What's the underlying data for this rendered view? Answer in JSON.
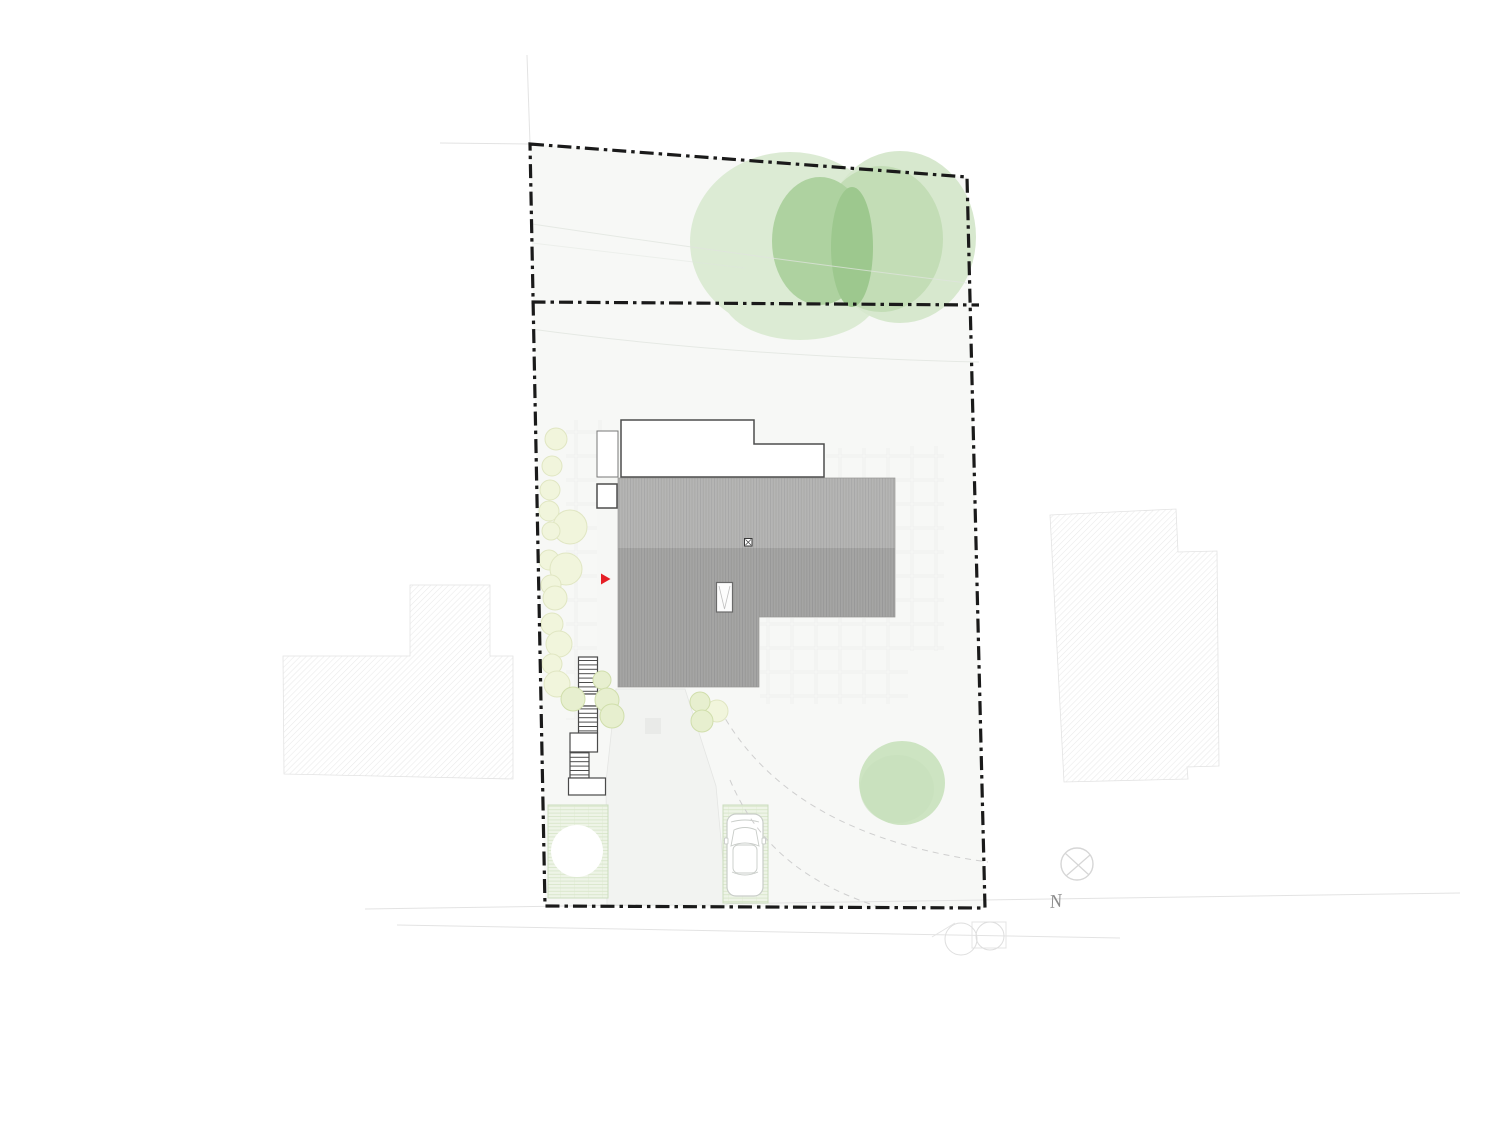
{
  "compass": {
    "north_label": "N"
  },
  "colors": {
    "boundary": "#1a1a1a",
    "interior": "#f7f8f6",
    "roof-light": "#b5b5b4",
    "roof-line-light": "#a7a7a6",
    "roof-dark": "#a5a5a4",
    "roof-line-dark": "#979796",
    "building-outline": "#4d4d4d",
    "hatch": "#e9e9e9",
    "driveway": "#f2f3f1",
    "driveway-edge": "#e4e5e3",
    "ghost": "#efefef",
    "faint": "#e3e3e3",
    "contour": "#e0e4de",
    "tree-pale": "#dcebd4",
    "tree-mid": "#c3ddb6",
    "tree-dark": "#aed2a0",
    "tree-overlap": "#9dc88e",
    "tree-single": "#cde4c2",
    "grass-bg": "#eef4e7",
    "grass-line": "#d9e7cb",
    "grass-border": "#cbdcbd",
    "shrub-pale": "#f1f5dc",
    "shrub-pale-edge": "#e0e6c2",
    "shrub-green": "#e7efcf",
    "shrub-green-edge": "#d0deab",
    "accent-red": "#e51f26",
    "compass-gray": "#d6d6d6",
    "label-gray": "#8a8a8a",
    "car-outline": "#c9cdc9"
  }
}
